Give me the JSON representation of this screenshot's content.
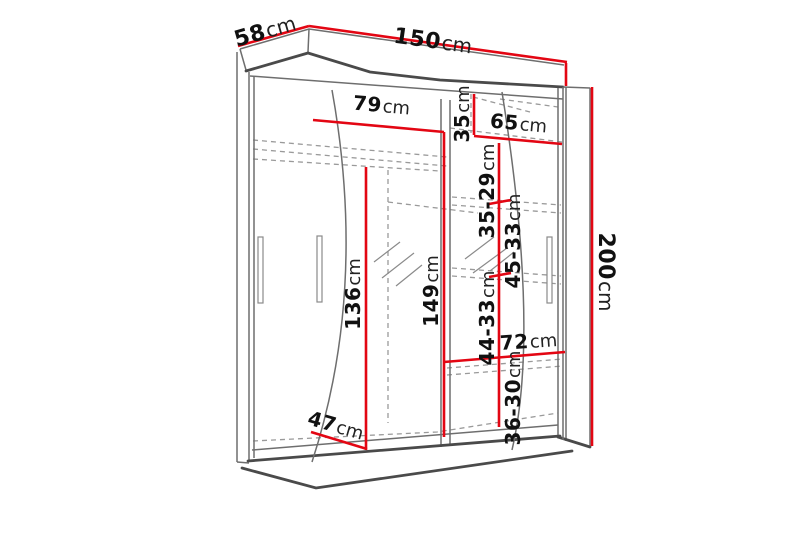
{
  "page": {
    "background": "#ffffff"
  },
  "diagram": {
    "type": "furniture-dimension-drawing",
    "subject": "two-door sliding wardrobe with curved mirror front",
    "unit": "cm",
    "colors": {
      "dimension_line": "#e30613",
      "outline": "#4a4a4a",
      "hidden_line": "#9a9a9a",
      "label": "#111111"
    },
    "dimensions": {
      "depth": {
        "value": "58",
        "unit": "cm"
      },
      "width": {
        "value": "150",
        "unit": "cm"
      },
      "height": {
        "value": "200",
        "unit": "cm"
      },
      "left_section_width": {
        "value": "79",
        "unit": "cm"
      },
      "top_shelf_height": {
        "value": "35",
        "unit": "cm"
      },
      "right_section_width": {
        "value": "65",
        "unit": "cm"
      },
      "shelf_gap_1": {
        "value": "35-29",
        "unit": "cm"
      },
      "shelf_gap_2": {
        "value": "45-33",
        "unit": "cm"
      },
      "hanging_height": {
        "value": "136",
        "unit": "cm"
      },
      "interior_height": {
        "value": "149",
        "unit": "cm"
      },
      "shelf_gap_3": {
        "value": "44-33",
        "unit": "cm"
      },
      "bottom_shelf_width": {
        "value": "72",
        "unit": "cm"
      },
      "shelf_gap_4": {
        "value": "36-30",
        "unit": "cm"
      },
      "interior_depth": {
        "value": "47",
        "unit": "cm"
      }
    }
  }
}
